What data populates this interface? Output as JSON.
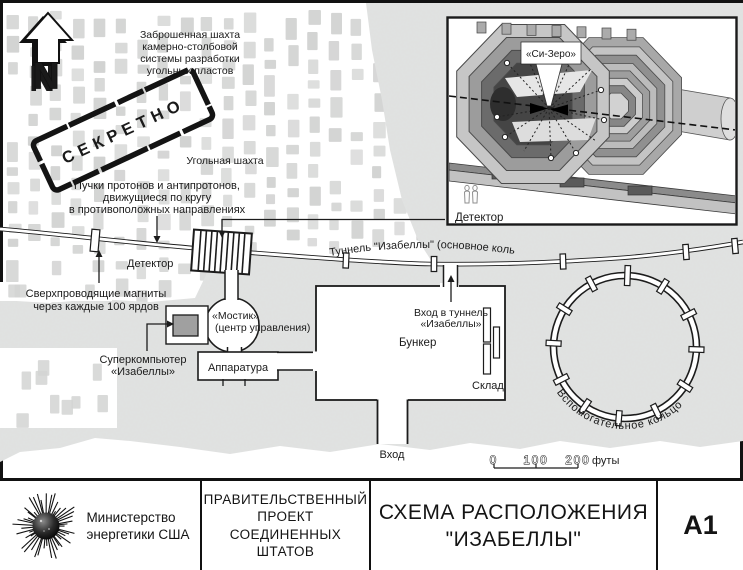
{
  "colors": {
    "ink": "#1a1a1a",
    "brick": "#d4d5d4",
    "ground": "#dfe0df",
    "paper": "#ffffff"
  },
  "map": {
    "north": "N",
    "stamp": "СЕКРЕТНО",
    "abandoned_mine": [
      "Заброшенная шахта",
      "камерно-столбовой",
      "системы разработки",
      "угольных пластов"
    ],
    "coal_mine": "Угольная шахта",
    "beams": [
      "Пучки протонов и антипротонов,",
      "движущиеся по кругу",
      "в противоположных направлениях"
    ],
    "detector_left": "Детектор",
    "magnets": [
      "Сверхпроводящие магниты",
      "через каждые 100 ярдов"
    ],
    "supercomputer": [
      "Суперкомпьютер",
      "«Изабеллы»"
    ],
    "bridge": [
      "«Мостик»",
      "(центр управления)"
    ],
    "apparatus": "Аппаратура",
    "bunker": "Бункер",
    "tunnel_entrance": [
      "Вход в туннель",
      "«Изабеллы»"
    ],
    "storage": "Склад",
    "entrance": "Вход",
    "main_tunnel": "Туннель \"Изабеллы\" (основное кольцо)",
    "aux_ring": "Вспомогательное кольцо",
    "scale": {
      "zero": "0",
      "hundred": "100",
      "twohundred": "200",
      "unit": "футы"
    }
  },
  "inset": {
    "c_zero": "«Си-Зеро»",
    "detector": "Детектор"
  },
  "titleblock": {
    "agency": [
      "Министерство",
      "энергетики США"
    ],
    "project": [
      "ПРАВИТЕЛЬСТВЕННЫЙ",
      "ПРОЕКТ",
      "СОЕДИНЕННЫХ",
      "ШТАТОВ"
    ],
    "title": [
      "СХЕМА РАСПОЛОЖЕНИЯ",
      "\"ИЗАБЕЛЛЫ\""
    ],
    "sheet": "А1"
  }
}
